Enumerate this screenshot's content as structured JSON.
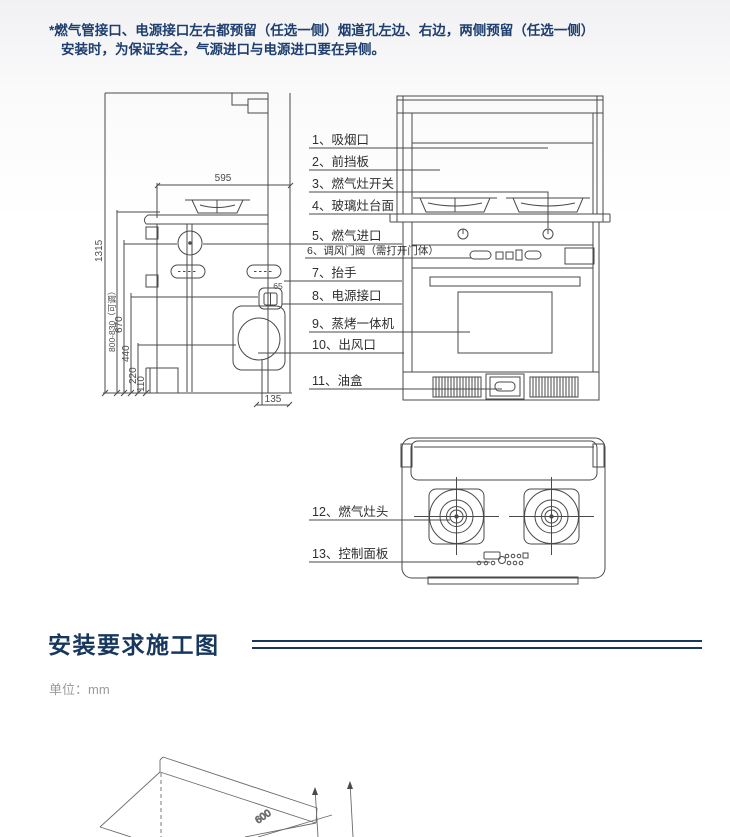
{
  "note": {
    "line1": "*燃气管接口、电源接口左右都预留（任选一侧）烟道孔左边、右边，两侧预留（任选一侧）",
    "line2": "安装时，为保证安全，气源进口与电源进口要在异侧。"
  },
  "parts": {
    "labels": [
      "1、吸烟口",
      "2、前挡板",
      "3、燃气灶开关",
      "4、玻璃灶台面",
      "5、燃气进口",
      "6、调风门阀（需打开门体）",
      "7、抬手",
      "8、电源接口",
      "9、蒸烤一体机",
      "10、出风口",
      "11、油盒",
      "12、燃气灶头",
      "13、控制面板"
    ]
  },
  "dimensions": {
    "top_width": "595",
    "total_height": "1315",
    "counter_height": "800-830（可调）",
    "gas_inlet_height": "670",
    "power_height": "440",
    "outlet_height": "220",
    "pipe_height": "110",
    "outlet_offset": "135",
    "power_offset": "65",
    "depth": "600"
  },
  "section": {
    "title": "安装要求施工图",
    "unit_label": "单位：mm"
  },
  "colors": {
    "accent": "#17375e",
    "line": "#4a4a4a",
    "muted_text": "#9b9b9b"
  }
}
